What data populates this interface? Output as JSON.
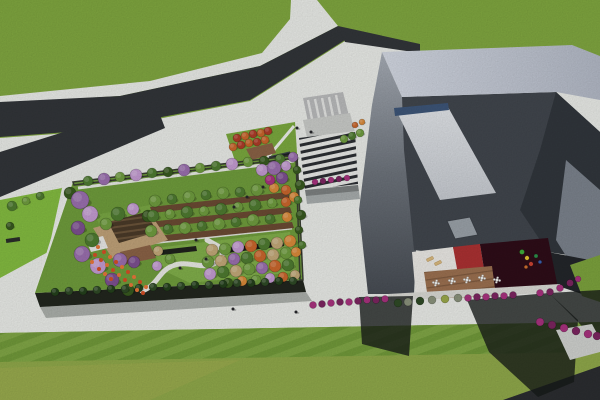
{
  "meta": {
    "view_label": "aerial-architectural-render",
    "canvas": {
      "width": 600,
      "height": 400
    }
  },
  "palette": {
    "grass": "#7ca23d",
    "grass_top": "#7fa63f",
    "grass_bottom": "#8fa84a",
    "grass_tint": "#a5ad52",
    "pavement": "#e9ebe7",
    "pavement_shade": "#cfd1ce",
    "road": "#323539",
    "road_dark": "#2b2d30",
    "crosswalk": "#b9babb",
    "apron": "#c9cbc8",
    "left_strip": "#83bb40",
    "garden_lawn": "#6f9c3c",
    "garden_lawn_light": "#84b24c",
    "facade": "#22261e",
    "parapet": "#3a3e33",
    "plaza_lawn": "#7aa83e",
    "deck_wood": "#8a6246",
    "deck_light": "#bfa178",
    "pavilion": "#e8e8e6",
    "kiosk": "#1c1f23",
    "orchard_strip": "#6b4a33",
    "planter": "#1f221c",
    "canopy_roof": "#a7acac",
    "bld_band_a": "#d3d8e2",
    "bld_band_b": "#b2b8c5",
    "bld_inner": "#41464d",
    "bld_inner_dark": "#31363c",
    "bld_right_band": "#7b828c",
    "bld_base_dark": "#23262a",
    "ramp": "#d6d9dd",
    "ramp_edge": "#3d5578",
    "skylight": "#9aa1a8",
    "floor_white": "#eae8e4",
    "floor_red": "#ab3132",
    "floor_maroon": "#2e0d18",
    "base_band": "#d9d9d4",
    "path_white": "#eceeea",
    "shadow": "rgba(22,26,24,0.78)",
    "shadow_soft": "rgba(30,36,30,0.30)",
    "lounger": "#d9b97e",
    "tree": {
      "g1": "#6f9c3f",
      "g2": "#4e7a30",
      "g3": "#38591f",
      "g4": "#24401c",
      "p1": "#9a6fae",
      "p2": "#c39bd1",
      "p3": "#7d5090",
      "o1": "#c9662c",
      "o2": "#d98a3a",
      "t1": "#c2a878",
      "r1": "#a8327e",
      "r2": "#7c2560",
      "red": "#ad3c28",
      "gray": "#8a927c",
      "dk": "#2f4a26",
      "yg": "#9aa84a",
      "fl1": "#d44f26",
      "fl2": "#e8763a"
    }
  },
  "scene": {
    "trees": [
      {
        "x": 88,
        "y": 181,
        "r": 5,
        "c": "g2"
      },
      {
        "x": 104,
        "y": 179,
        "r": 6,
        "c": "p1"
      },
      {
        "x": 120,
        "y": 177,
        "r": 5,
        "c": "g1"
      },
      {
        "x": 136,
        "y": 175,
        "r": 6,
        "c": "p2"
      },
      {
        "x": 152,
        "y": 173,
        "r": 5,
        "c": "g2"
      },
      {
        "x": 168,
        "y": 172,
        "r": 5,
        "c": "g3"
      },
      {
        "x": 184,
        "y": 170,
        "r": 6,
        "c": "p1"
      },
      {
        "x": 200,
        "y": 168,
        "r": 5,
        "c": "g1"
      },
      {
        "x": 216,
        "y": 166,
        "r": 5,
        "c": "g2"
      },
      {
        "x": 232,
        "y": 164,
        "r": 6,
        "c": "p2"
      },
      {
        "x": 248,
        "y": 162,
        "r": 5,
        "c": "g1"
      },
      {
        "x": 264,
        "y": 161,
        "r": 5,
        "c": "g3"
      },
      {
        "x": 280,
        "y": 159,
        "r": 5,
        "c": "g2"
      },
      {
        "x": 293,
        "y": 157,
        "r": 5,
        "c": "p1"
      },
      {
        "x": 70,
        "y": 193,
        "r": 6,
        "c": "g3"
      },
      {
        "x": 80,
        "y": 200,
        "r": 9,
        "c": "p1"
      },
      {
        "x": 90,
        "y": 214,
        "r": 8,
        "c": "p2"
      },
      {
        "x": 78,
        "y": 228,
        "r": 7,
        "c": "p3"
      },
      {
        "x": 92,
        "y": 240,
        "r": 7,
        "c": "g2"
      },
      {
        "x": 82,
        "y": 254,
        "r": 8,
        "c": "p1"
      },
      {
        "x": 98,
        "y": 266,
        "r": 8,
        "c": "p2"
      },
      {
        "x": 112,
        "y": 280,
        "r": 7,
        "c": "p3"
      },
      {
        "x": 128,
        "y": 290,
        "r": 6,
        "c": "g3"
      },
      {
        "x": 118,
        "y": 214,
        "r": 7,
        "c": "g2"
      },
      {
        "x": 133,
        "y": 209,
        "r": 6,
        "c": "p2"
      },
      {
        "x": 148,
        "y": 216,
        "r": 6,
        "c": "g3"
      },
      {
        "x": 106,
        "y": 224,
        "r": 6,
        "c": "g1"
      },
      {
        "x": 120,
        "y": 260,
        "r": 7,
        "c": "p1"
      },
      {
        "x": 134,
        "y": 262,
        "r": 6,
        "c": "p3"
      },
      {
        "x": 155,
        "y": 201,
        "r": 6,
        "c": "g1"
      },
      {
        "x": 172,
        "y": 199,
        "r": 5,
        "c": "g2"
      },
      {
        "x": 189,
        "y": 197,
        "r": 6,
        "c": "g1"
      },
      {
        "x": 206,
        "y": 195,
        "r": 5,
        "c": "g2"
      },
      {
        "x": 223,
        "y": 193,
        "r": 6,
        "c": "g1"
      },
      {
        "x": 240,
        "y": 192,
        "r": 5,
        "c": "g2"
      },
      {
        "x": 257,
        "y": 190,
        "r": 6,
        "c": "g1"
      },
      {
        "x": 274,
        "y": 188,
        "r": 5,
        "c": "o2"
      },
      {
        "x": 153,
        "y": 216,
        "r": 6,
        "c": "g2"
      },
      {
        "x": 170,
        "y": 214,
        "r": 5,
        "c": "g1"
      },
      {
        "x": 187,
        "y": 212,
        "r": 6,
        "c": "g2"
      },
      {
        "x": 204,
        "y": 211,
        "r": 5,
        "c": "g1"
      },
      {
        "x": 221,
        "y": 209,
        "r": 6,
        "c": "g2"
      },
      {
        "x": 238,
        "y": 207,
        "r": 5,
        "c": "g1"
      },
      {
        "x": 255,
        "y": 205,
        "r": 6,
        "c": "g2"
      },
      {
        "x": 272,
        "y": 203,
        "r": 5,
        "c": "g1"
      },
      {
        "x": 286,
        "y": 202,
        "r": 5,
        "c": "o1"
      },
      {
        "x": 151,
        "y": 231,
        "r": 6,
        "c": "g1"
      },
      {
        "x": 168,
        "y": 229,
        "r": 5,
        "c": "g2"
      },
      {
        "x": 185,
        "y": 228,
        "r": 6,
        "c": "g1"
      },
      {
        "x": 202,
        "y": 226,
        "r": 5,
        "c": "g2"
      },
      {
        "x": 219,
        "y": 224,
        "r": 6,
        "c": "g1"
      },
      {
        "x": 236,
        "y": 222,
        "r": 5,
        "c": "g2"
      },
      {
        "x": 253,
        "y": 220,
        "r": 6,
        "c": "g1"
      },
      {
        "x": 270,
        "y": 219,
        "r": 5,
        "c": "g2"
      },
      {
        "x": 287,
        "y": 217,
        "r": 5,
        "c": "o2"
      },
      {
        "x": 262,
        "y": 170,
        "r": 6,
        "c": "p2"
      },
      {
        "x": 274,
        "y": 168,
        "r": 7,
        "c": "p1"
      },
      {
        "x": 286,
        "y": 166,
        "r": 5,
        "c": "p2"
      },
      {
        "x": 270,
        "y": 180,
        "r": 5,
        "c": "r1"
      },
      {
        "x": 282,
        "y": 178,
        "r": 6,
        "c": "p3"
      },
      {
        "x": 286,
        "y": 190,
        "r": 5,
        "c": "o1"
      },
      {
        "x": 294,
        "y": 197,
        "r": 5,
        "c": "o2"
      },
      {
        "x": 297,
        "y": 170,
        "r": 4,
        "c": "g3"
      },
      {
        "x": 300,
        "y": 185,
        "r": 5,
        "c": "g3"
      },
      {
        "x": 298,
        "y": 200,
        "r": 4,
        "c": "g2"
      },
      {
        "x": 301,
        "y": 215,
        "r": 5,
        "c": "g3"
      },
      {
        "x": 299,
        "y": 230,
        "r": 4,
        "c": "g3"
      },
      {
        "x": 302,
        "y": 245,
        "r": 4,
        "c": "g2"
      },
      {
        "x": 212,
        "y": 250,
        "r": 6,
        "c": "t1"
      },
      {
        "x": 225,
        "y": 249,
        "r": 6,
        "c": "g1"
      },
      {
        "x": 238,
        "y": 247,
        "r": 6,
        "c": "p2"
      },
      {
        "x": 251,
        "y": 246,
        "r": 6,
        "c": "o1"
      },
      {
        "x": 264,
        "y": 244,
        "r": 6,
        "c": "g2"
      },
      {
        "x": 277,
        "y": 243,
        "r": 6,
        "c": "t1"
      },
      {
        "x": 290,
        "y": 241,
        "r": 6,
        "c": "o2"
      },
      {
        "x": 208,
        "y": 262,
        "r": 6,
        "c": "g1"
      },
      {
        "x": 221,
        "y": 261,
        "r": 6,
        "c": "t1"
      },
      {
        "x": 234,
        "y": 259,
        "r": 6,
        "c": "p1"
      },
      {
        "x": 247,
        "y": 258,
        "r": 6,
        "c": "g2"
      },
      {
        "x": 260,
        "y": 256,
        "r": 6,
        "c": "o1"
      },
      {
        "x": 273,
        "y": 255,
        "r": 6,
        "c": "t1"
      },
      {
        "x": 286,
        "y": 253,
        "r": 6,
        "c": "g1"
      },
      {
        "x": 296,
        "y": 252,
        "r": 5,
        "c": "o2"
      },
      {
        "x": 210,
        "y": 274,
        "r": 6,
        "c": "p2"
      },
      {
        "x": 223,
        "y": 272,
        "r": 6,
        "c": "g2"
      },
      {
        "x": 236,
        "y": 271,
        "r": 6,
        "c": "t1"
      },
      {
        "x": 249,
        "y": 269,
        "r": 6,
        "c": "g1"
      },
      {
        "x": 262,
        "y": 268,
        "r": 6,
        "c": "p1"
      },
      {
        "x": 275,
        "y": 266,
        "r": 6,
        "c": "o1"
      },
      {
        "x": 288,
        "y": 265,
        "r": 6,
        "c": "g2"
      },
      {
        "x": 228,
        "y": 283,
        "r": 5,
        "c": "g3"
      },
      {
        "x": 242,
        "y": 281,
        "r": 5,
        "c": "o2"
      },
      {
        "x": 256,
        "y": 280,
        "r": 5,
        "c": "g1"
      },
      {
        "x": 270,
        "y": 278,
        "r": 5,
        "c": "p2"
      },
      {
        "x": 283,
        "y": 277,
        "r": 5,
        "c": "o1"
      },
      {
        "x": 295,
        "y": 275,
        "r": 5,
        "c": "t1"
      },
      {
        "x": 158,
        "y": 251,
        "r": 5,
        "c": "t1"
      },
      {
        "x": 170,
        "y": 259,
        "r": 5,
        "c": "g1"
      },
      {
        "x": 157,
        "y": 266,
        "r": 5,
        "c": "p2"
      },
      {
        "x": 55,
        "y": 292,
        "r": 4,
        "c": "g4"
      },
      {
        "x": 69,
        "y": 291,
        "r": 4,
        "c": "dk"
      },
      {
        "x": 83,
        "y": 291,
        "r": 4,
        "c": "g4"
      },
      {
        "x": 97,
        "y": 290,
        "r": 4,
        "c": "dk"
      },
      {
        "x": 111,
        "y": 289,
        "r": 4,
        "c": "g4"
      },
      {
        "x": 125,
        "y": 289,
        "r": 4,
        "c": "dk"
      },
      {
        "x": 139,
        "y": 288,
        "r": 4,
        "c": "g4"
      },
      {
        "x": 153,
        "y": 287,
        "r": 4,
        "c": "dk"
      },
      {
        "x": 167,
        "y": 287,
        "r": 4,
        "c": "g4"
      },
      {
        "x": 181,
        "y": 286,
        "r": 4,
        "c": "dk"
      },
      {
        "x": 195,
        "y": 285,
        "r": 4,
        "c": "g4"
      },
      {
        "x": 209,
        "y": 285,
        "r": 4,
        "c": "dk"
      },
      {
        "x": 223,
        "y": 284,
        "r": 4,
        "c": "g4"
      },
      {
        "x": 237,
        "y": 283,
        "r": 4,
        "c": "dk"
      },
      {
        "x": 251,
        "y": 283,
        "r": 4,
        "c": "g4"
      },
      {
        "x": 265,
        "y": 282,
        "r": 4,
        "c": "dk"
      },
      {
        "x": 279,
        "y": 281,
        "r": 4,
        "c": "g4"
      },
      {
        "x": 293,
        "y": 281,
        "r": 4,
        "c": "dk"
      },
      {
        "x": 12,
        "y": 206,
        "r": 5,
        "c": "g2"
      },
      {
        "x": 26,
        "y": 201,
        "r": 4,
        "c": "g1"
      },
      {
        "x": 40,
        "y": 196,
        "r": 4,
        "c": "g2"
      },
      {
        "x": 10,
        "y": 226,
        "r": 4,
        "c": "g3"
      },
      {
        "x": 237,
        "y": 138,
        "r": 4,
        "c": "red"
      },
      {
        "x": 245,
        "y": 136,
        "r": 4,
        "c": "o1"
      },
      {
        "x": 253,
        "y": 134,
        "r": 4,
        "c": "red"
      },
      {
        "x": 261,
        "y": 133,
        "r": 4,
        "c": "o1"
      },
      {
        "x": 268,
        "y": 131,
        "r": 4,
        "c": "red"
      },
      {
        "x": 233,
        "y": 147,
        "r": 4,
        "c": "o1"
      },
      {
        "x": 241,
        "y": 145,
        "r": 4,
        "c": "red"
      },
      {
        "x": 249,
        "y": 143,
        "r": 4,
        "c": "o1"
      },
      {
        "x": 257,
        "y": 142,
        "r": 4,
        "c": "red"
      },
      {
        "x": 265,
        "y": 140,
        "r": 4,
        "c": "o1"
      },
      {
        "x": 344,
        "y": 139,
        "r": 4,
        "c": "g1"
      },
      {
        "x": 352,
        "y": 136,
        "r": 4,
        "c": "g2"
      },
      {
        "x": 360,
        "y": 133,
        "r": 4,
        "c": "g1"
      },
      {
        "x": 355,
        "y": 125,
        "r": 3,
        "c": "o1"
      },
      {
        "x": 362,
        "y": 122,
        "r": 3,
        "c": "o2"
      }
    ],
    "shrubs": [
      {
        "x": 313,
        "y": 305,
        "r": 3.5,
        "c": "r1"
      },
      {
        "x": 322,
        "y": 304,
        "r": 3.5,
        "c": "r2"
      },
      {
        "x": 331,
        "y": 303,
        "r": 3.5,
        "c": "r1"
      },
      {
        "x": 340,
        "y": 302,
        "r": 3.5,
        "c": "r2"
      },
      {
        "x": 349,
        "y": 302,
        "r": 3.5,
        "c": "r1"
      },
      {
        "x": 358,
        "y": 301,
        "r": 3.5,
        "c": "r2"
      },
      {
        "x": 367,
        "y": 300,
        "r": 3.5,
        "c": "r1"
      },
      {
        "x": 376,
        "y": 300,
        "r": 3.5,
        "c": "r2"
      },
      {
        "x": 385,
        "y": 299,
        "r": 3.5,
        "c": "r1"
      },
      {
        "x": 398,
        "y": 303,
        "r": 4,
        "c": "dk"
      },
      {
        "x": 408,
        "y": 302,
        "r": 4,
        "c": "gray"
      },
      {
        "x": 420,
        "y": 301,
        "r": 4,
        "c": "dk"
      },
      {
        "x": 432,
        "y": 300,
        "r": 4,
        "c": "gray"
      },
      {
        "x": 445,
        "y": 299,
        "r": 4,
        "c": "yg"
      },
      {
        "x": 458,
        "y": 298,
        "r": 4,
        "c": "gray"
      },
      {
        "x": 468,
        "y": 298,
        "r": 3.5,
        "c": "r1"
      },
      {
        "x": 477,
        "y": 297,
        "r": 3.5,
        "c": "r2"
      },
      {
        "x": 486,
        "y": 297,
        "r": 3.5,
        "c": "r1"
      },
      {
        "x": 495,
        "y": 296,
        "r": 3.5,
        "c": "r2"
      },
      {
        "x": 504,
        "y": 296,
        "r": 3.5,
        "c": "r1"
      },
      {
        "x": 513,
        "y": 295,
        "r": 3.5,
        "c": "r2"
      },
      {
        "x": 540,
        "y": 293,
        "r": 3.5,
        "c": "r1"
      },
      {
        "x": 550,
        "y": 292,
        "r": 3.5,
        "c": "r2"
      },
      {
        "x": 560,
        "y": 288,
        "r": 3.5,
        "c": "r1"
      },
      {
        "x": 570,
        "y": 283,
        "r": 3.5,
        "c": "r2"
      },
      {
        "x": 578,
        "y": 279,
        "r": 3,
        "c": "r1"
      },
      {
        "x": 540,
        "y": 322,
        "r": 4,
        "c": "r1"
      },
      {
        "x": 552,
        "y": 325,
        "r": 4,
        "c": "r2"
      },
      {
        "x": 564,
        "y": 328,
        "r": 4,
        "c": "r1"
      },
      {
        "x": 576,
        "y": 331,
        "r": 4,
        "c": "r2"
      },
      {
        "x": 588,
        "y": 334,
        "r": 4,
        "c": "r1"
      },
      {
        "x": 597,
        "y": 336,
        "r": 4,
        "c": "r2"
      },
      {
        "x": 315,
        "y": 182,
        "r": 3,
        "c": "r1"
      },
      {
        "x": 323,
        "y": 181,
        "r": 3,
        "c": "r2"
      },
      {
        "x": 331,
        "y": 180,
        "r": 3,
        "c": "r1"
      },
      {
        "x": 339,
        "y": 179,
        "r": 3,
        "c": "r2"
      },
      {
        "x": 347,
        "y": 178,
        "r": 3,
        "c": "r1"
      }
    ],
    "flowers": [
      {
        "x": 98,
        "y": 247
      },
      {
        "x": 104,
        "y": 252
      },
      {
        "x": 110,
        "y": 257
      },
      {
        "x": 116,
        "y": 262
      },
      {
        "x": 122,
        "y": 267
      },
      {
        "x": 128,
        "y": 272
      },
      {
        "x": 134,
        "y": 277
      },
      {
        "x": 140,
        "y": 282
      },
      {
        "x": 146,
        "y": 287
      },
      {
        "x": 101,
        "y": 260
      },
      {
        "x": 107,
        "y": 265
      },
      {
        "x": 113,
        "y": 270
      },
      {
        "x": 119,
        "y": 275
      },
      {
        "x": 125,
        "y": 280
      },
      {
        "x": 131,
        "y": 285
      },
      {
        "x": 95,
        "y": 255
      },
      {
        "x": 137,
        "y": 290
      },
      {
        "x": 143,
        "y": 293
      },
      {
        "x": 92,
        "y": 262
      },
      {
        "x": 99,
        "y": 269
      },
      {
        "x": 105,
        "y": 274
      },
      {
        "x": 111,
        "y": 279
      }
    ],
    "people": [
      {
        "x": 297,
        "y": 128
      },
      {
        "x": 311,
        "y": 132
      },
      {
        "x": 263,
        "y": 187
      },
      {
        "x": 247,
        "y": 197
      },
      {
        "x": 234,
        "y": 207
      },
      {
        "x": 206,
        "y": 259
      },
      {
        "x": 233,
        "y": 309
      },
      {
        "x": 296,
        "y": 312
      },
      {
        "x": 180,
        "y": 268
      },
      {
        "x": 196,
        "y": 240
      }
    ],
    "tables": [
      {
        "x": 436,
        "y": 283
      },
      {
        "x": 452,
        "y": 281
      },
      {
        "x": 467,
        "y": 280
      },
      {
        "x": 482,
        "y": 278
      },
      {
        "x": 497,
        "y": 280
      }
    ],
    "loungers": [
      {
        "x": 430,
        "y": 259,
        "rot": -25
      },
      {
        "x": 438,
        "y": 263,
        "rot": -25
      }
    ],
    "playground": [
      {
        "x": 522,
        "y": 252,
        "c": "#3fae3a",
        "r": 2.5
      },
      {
        "x": 527,
        "y": 258,
        "c": "#e3c532",
        "r": 2.2
      },
      {
        "x": 531,
        "y": 264,
        "c": "#cc4433",
        "r": 2.2
      },
      {
        "x": 536,
        "y": 256,
        "c": "#2f8f4a",
        "r": 2
      },
      {
        "x": 540,
        "y": 262,
        "c": "#3a62b0",
        "r": 1.8
      },
      {
        "x": 526,
        "y": 267,
        "c": "#d07030",
        "r": 1.8
      }
    ]
  }
}
